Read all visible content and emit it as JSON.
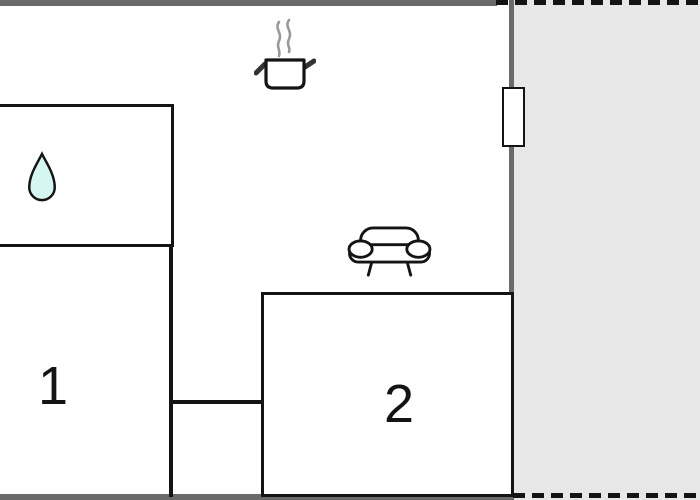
{
  "floorplan": {
    "rooms": [
      {
        "id": "room-1",
        "label": "1"
      },
      {
        "id": "room-2",
        "label": "2"
      }
    ],
    "icons": [
      {
        "name": "water-drop-icon"
      },
      {
        "name": "cooking-pot-icon"
      },
      {
        "name": "steam-icon"
      },
      {
        "name": "sofa-icon"
      },
      {
        "name": "window-icon"
      }
    ],
    "areas": {
      "terrace_style": "dashed-outline"
    },
    "colors": {
      "wall_gray": "#6a6a6a",
      "line_black": "#141414",
      "terrace_fill": "#e7e7e7",
      "drop_fill": "#d6f6f2",
      "steam_gray": "#999999",
      "background": "#ffffff"
    }
  }
}
